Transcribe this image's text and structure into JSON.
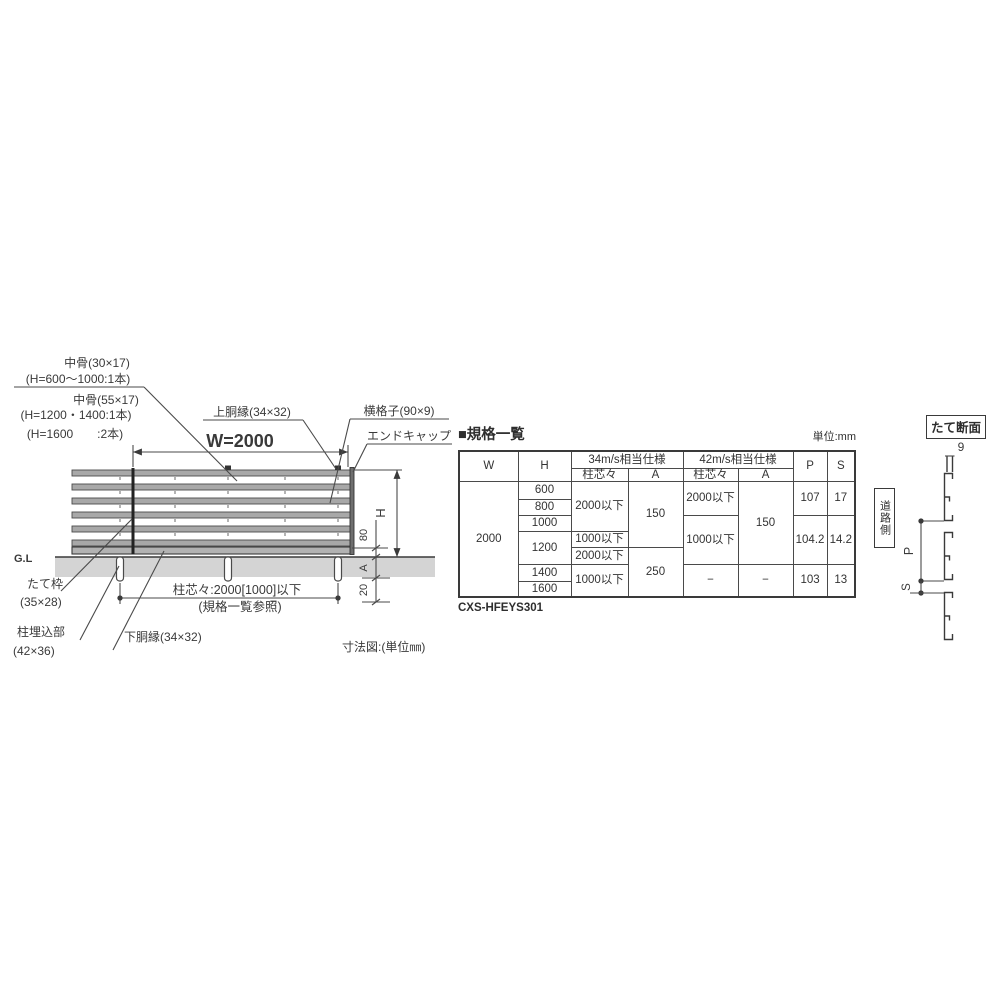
{
  "fence": {
    "labels": {
      "nakabone1": "中骨(30×17)",
      "nakabone1_note": "(H=600〜1000:1本)",
      "nakabone2": "中骨(55×17)",
      "nakabone2_note1": "(H=1200・1400:1本)",
      "nakabone2_note2": "(H=1600　　:2本)",
      "top_rail": "上胴縁(34×32)",
      "yokogoshi": "横格子(90×9)",
      "end_cap": "エンドキャップ",
      "tate_waku": "たて枠",
      "tate_waku_size": "(35×28)",
      "post_embed": "柱埋込部",
      "post_embed_size": "(42×36)",
      "bottom_rail": "下胴縁(34×32)",
      "gl": "G.L"
    },
    "dims": {
      "width": "W=2000",
      "height": "H",
      "gap80": "80",
      "embed_a": "A",
      "below20": "20",
      "pitch": "柱芯々:2000[1000]以下",
      "pitch_note": "(規格一覧参照)"
    },
    "caption": "寸法図:(単位㎜)"
  },
  "section": {
    "title": "たて断面",
    "thickness": "9",
    "road_side": "道路側",
    "pitch_label": "P",
    "gap_label": "S"
  },
  "spec": {
    "title": "■規格一覧",
    "unit": "単位:mm",
    "model": "CXS-HFEYS301",
    "head": {
      "w": "W",
      "h": "H",
      "g34": "34m/s相当仕様",
      "g42": "42m/s相当仕様",
      "pitch": "柱芯々",
      "a": "A",
      "p": "P",
      "s": "S"
    },
    "w": "2000",
    "h600": "600",
    "h800": "800",
    "h1000": "1000",
    "h1200": "1200",
    "h1400": "1400",
    "h1600": "1600",
    "p34_1": "2000以下",
    "p34_2": "1000以下",
    "p34_3": "2000以下",
    "p34_4": "1000以下",
    "a34_1": "150",
    "a34_2": "250",
    "p42_1": "2000以下",
    "p42_2": "1000以下",
    "p42_3": "−",
    "a42_1": "150",
    "a42_2": "−",
    "pv_1": "107",
    "pv_2": "104.2",
    "pv_3": "103",
    "sv_1": "17",
    "sv_2": "14.2",
    "sv_3": "13"
  }
}
